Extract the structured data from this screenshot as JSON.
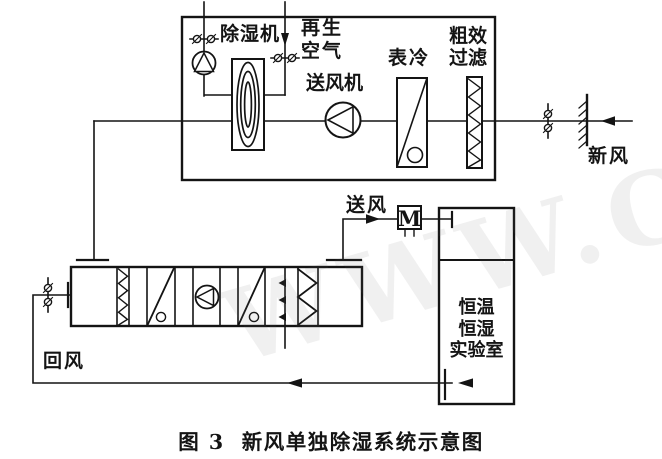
{
  "figure": {
    "caption_number": "图 3",
    "caption_title": "新风单独除湿系统示意图",
    "watermark": "WWW.C"
  },
  "top_unit": {
    "dehumidifier_label": "除湿机",
    "regen_air_line1": "再生",
    "regen_air_line2": "空气",
    "supply_fan_label": "送风机",
    "surface_cooler_label": "表冷",
    "coarse_filter_line1": "粗效",
    "coarse_filter_line2": "过滤"
  },
  "labels": {
    "fresh_air": "新风",
    "supply_air": "送风",
    "return_air": "回风",
    "heater_mark": "M"
  },
  "room": {
    "name_line1": "恒温",
    "name_line2": "恒湿",
    "name_line3": "实验室"
  },
  "colors": {
    "line": "#141414",
    "background": "#ffffff",
    "watermark_gray": "rgba(110,110,110,0.10)"
  },
  "symbols": [
    "fan-icon",
    "desiccant-wheel-icon",
    "cooling-coil-icon",
    "filter-icon",
    "damper-icon",
    "spray-humidifier-icon",
    "eliminator-icon",
    "electric-heater-icon",
    "wall-icon",
    "flow-arrow-icon",
    "flange-icon"
  ]
}
